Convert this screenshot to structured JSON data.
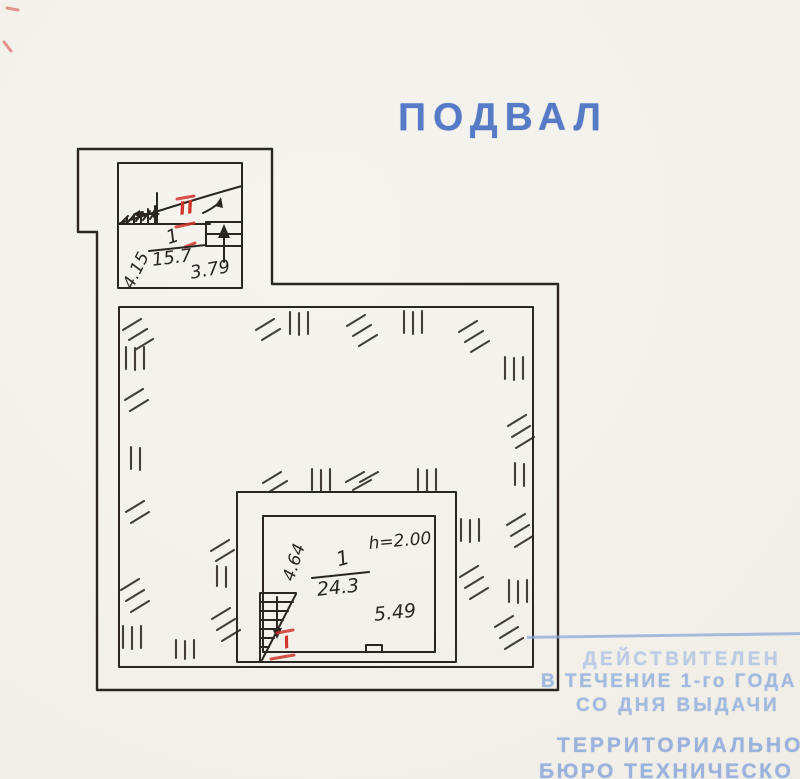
{
  "title": "ПОДВАЛ",
  "rooms": {
    "stair_room": {
      "roman": "II",
      "number": "1",
      "area": "15.7",
      "dim_side": "4.15",
      "dim_bottom": "3.79"
    },
    "cellar_room": {
      "roman": "I",
      "number": "1",
      "area": "24.3",
      "height": "h=2.00",
      "dim_bottom": "5.49",
      "dim_side": "4.64"
    }
  },
  "stamp": {
    "validity": [
      "ДЕЙСТВИТЕЛЕН",
      "В ТЕЧЕНИЕ 1-го ГОДА",
      "СО ДНЯ ВЫДАЧИ"
    ],
    "bureau": [
      "ТЕРРИТОРИАЛЬНО",
      "БЮРО ТЕХНИЧЕСКО"
    ]
  },
  "colors": {
    "paper": "#f4f2ec",
    "ink": "#2b2622",
    "red_annotation": "#cf352b",
    "title_blue": "#4a70c4",
    "stamp_blue": "#a3badf",
    "rule_blue": "#8ea8d8"
  }
}
